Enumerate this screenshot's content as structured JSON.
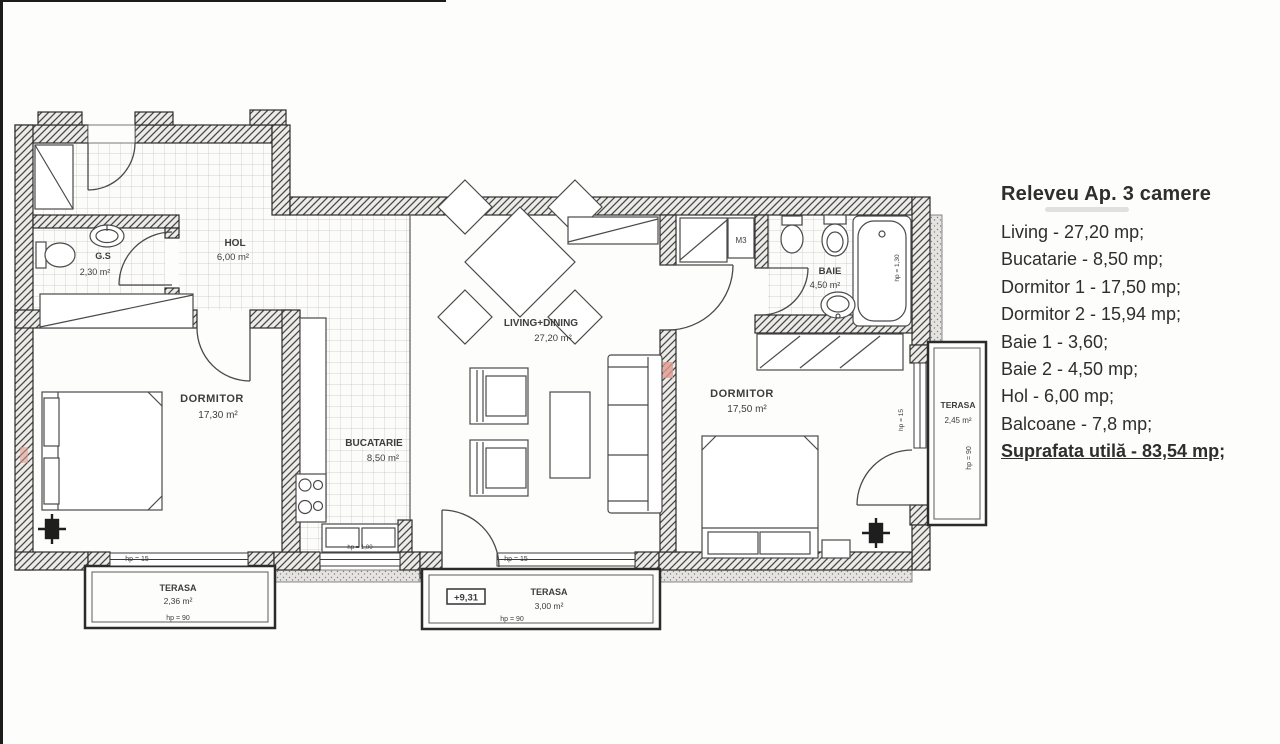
{
  "legend": {
    "title": "Releveu Ap. 3 camere",
    "items": [
      "Living - 27,20 mp;",
      "Bucatarie - 8,50 mp;",
      "Dormitor 1 - 17,50 mp;",
      "Dormitor 2 - 15,94 mp;",
      "Baie 1 - 3,60;",
      "Baie 2 - 4,50 mp;",
      "Hol - 6,00 mp;",
      "Balcoane - 7,8 mp;"
    ],
    "total": "Suprafata utilă - 83,54 mp;"
  },
  "plan": {
    "rooms": {
      "hol": {
        "name": "HOL",
        "area": "6,00 m²"
      },
      "gs": {
        "name": "G.S",
        "area": "2,30 m²"
      },
      "dormitor1": {
        "name": "DORMITOR",
        "area": "17,30 m²"
      },
      "bucatarie": {
        "name": "BUCATARIE",
        "area": "8,50 m²"
      },
      "living": {
        "name": "LIVING+DINING",
        "area": "27,20 m²"
      },
      "dormitor2": {
        "name": "DORMITOR",
        "area": "17,50 m²"
      },
      "baie": {
        "name": "BAIE",
        "area": "4,50 m²"
      },
      "terasa_left": {
        "name": "TERASA",
        "area": "2,36 m²"
      },
      "terasa_center": {
        "name": "TERASA",
        "area": "3,00 m²"
      },
      "terasa_right": {
        "name": "TERASA",
        "area": "2,45 m²"
      }
    },
    "annotations": {
      "m3": "M3",
      "level": "+9,31",
      "hp15": "hp = 15",
      "hp90": "hp = 90",
      "hp100": "hp = 1,00",
      "hp130": "hp = 1,30"
    }
  }
}
